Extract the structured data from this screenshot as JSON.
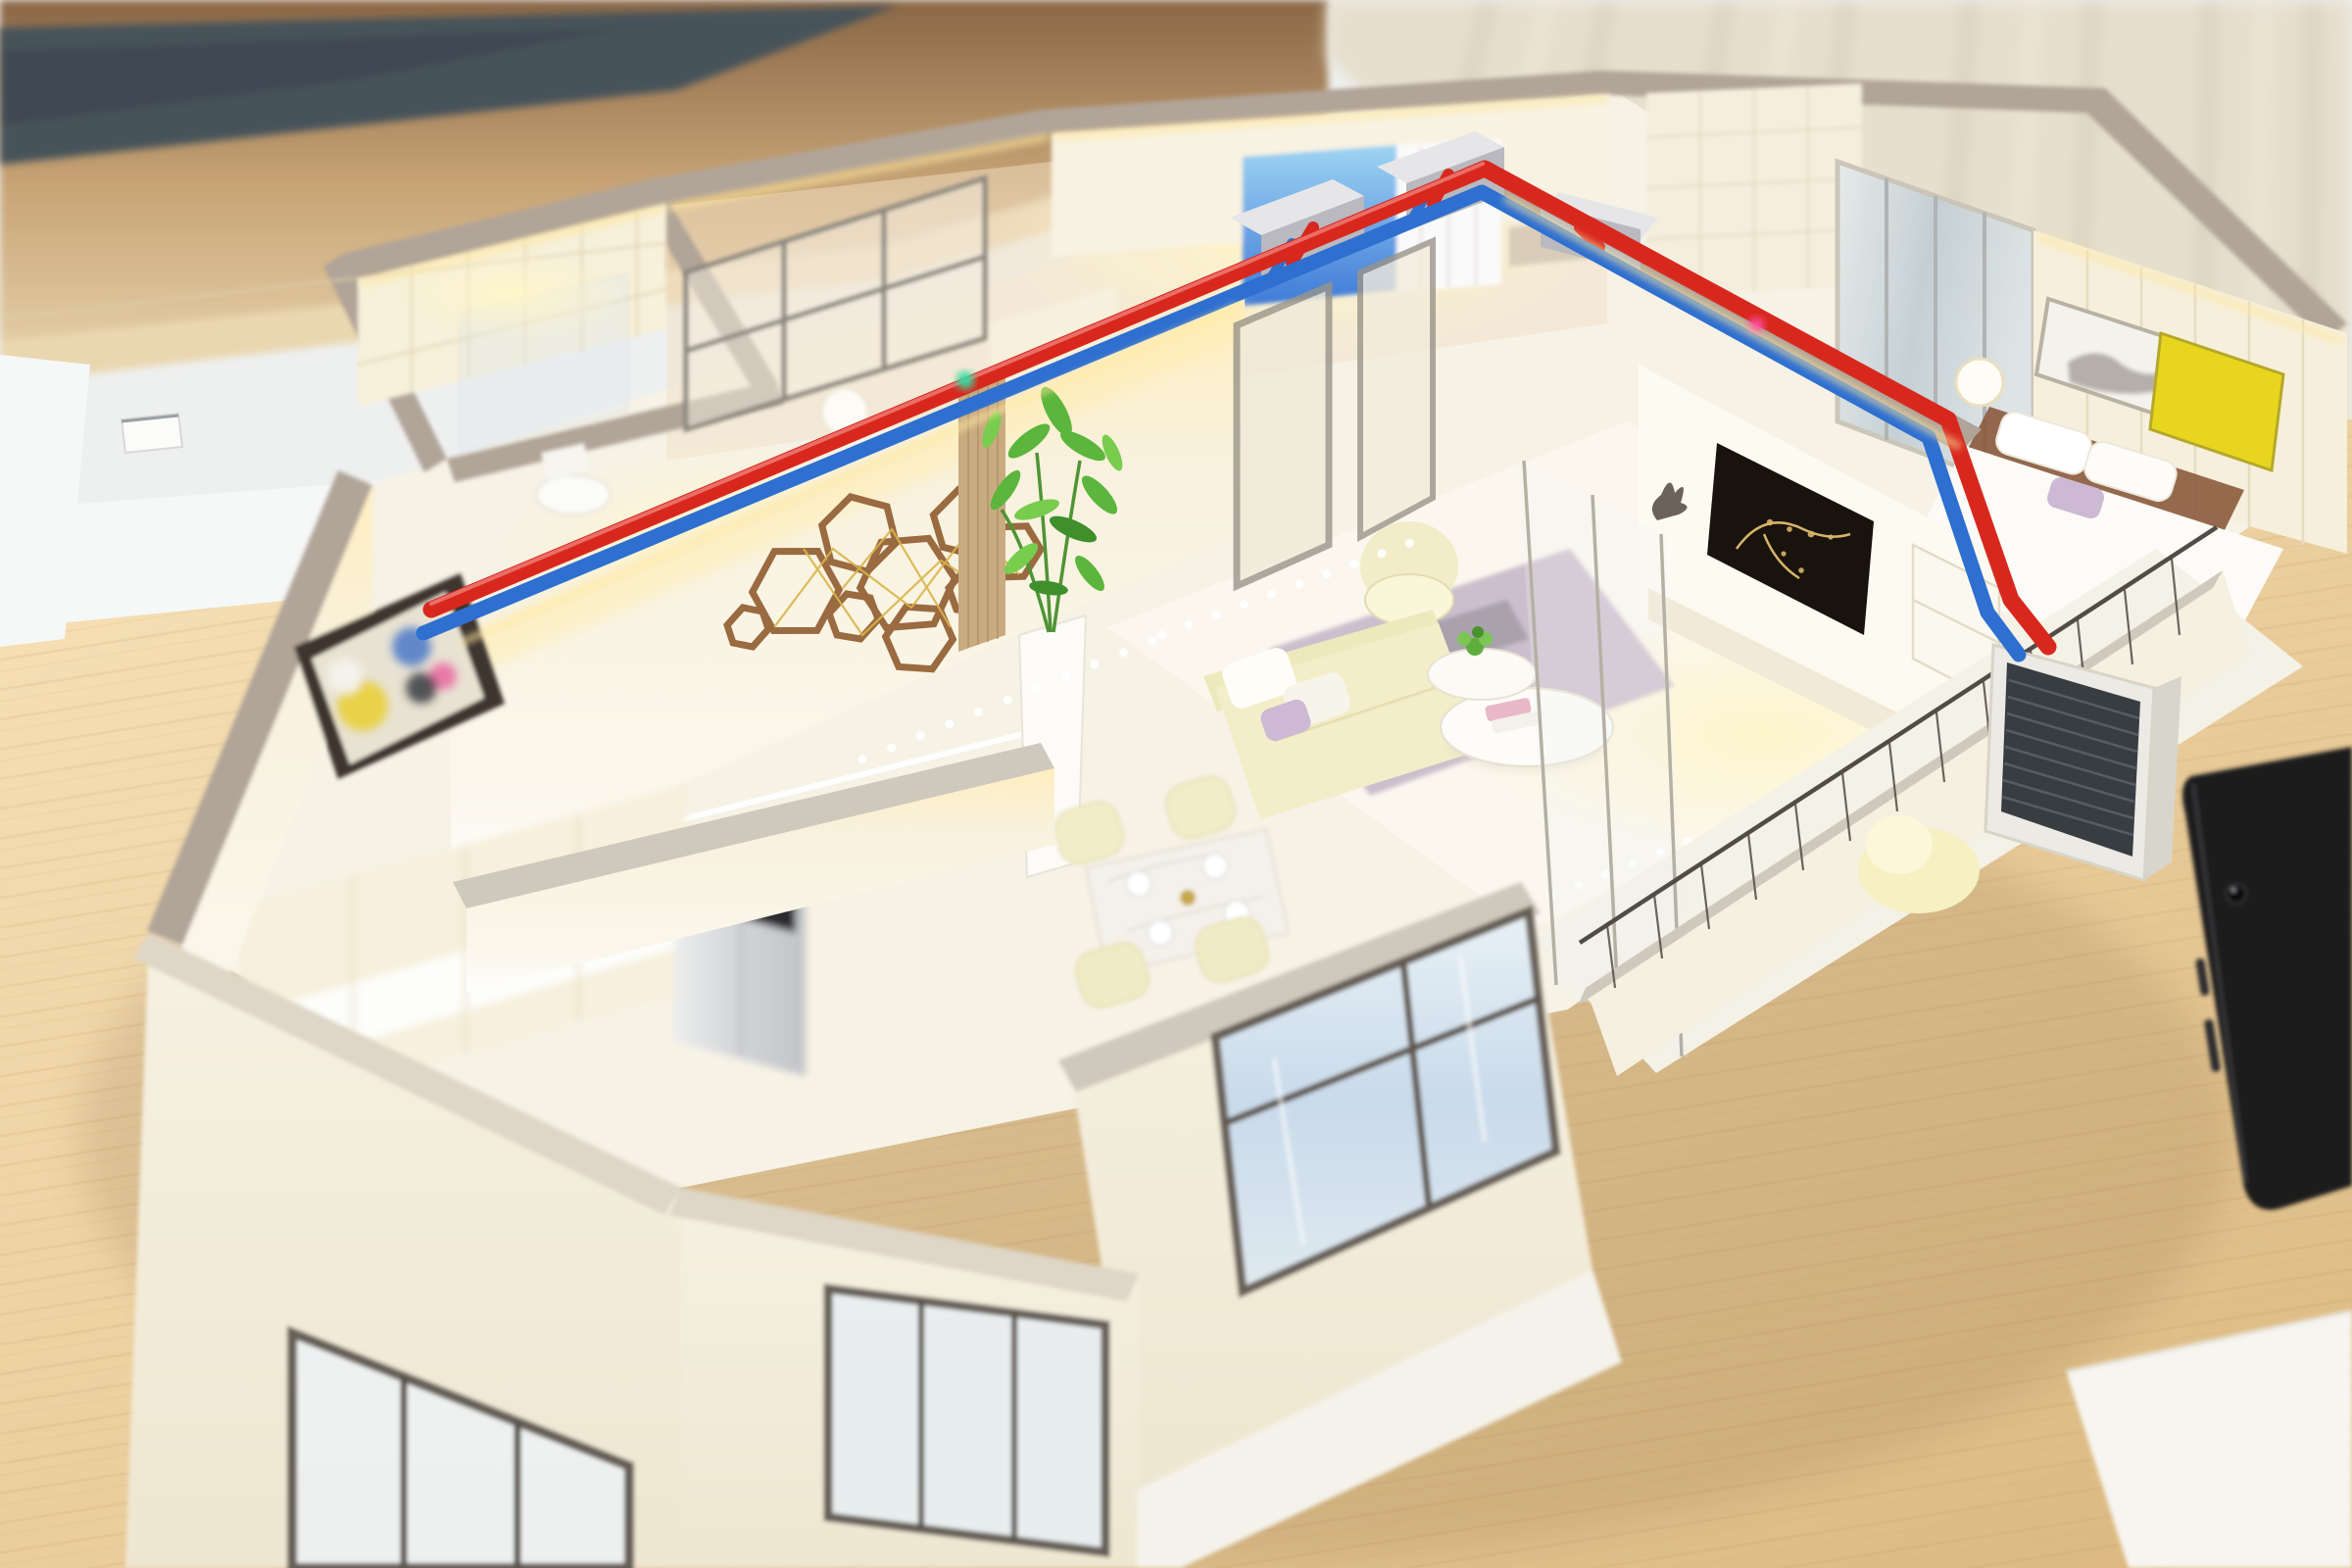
{
  "scene": {
    "type": "photograph",
    "subject": "Architectural cutaway scale model of an apartment with red/blue HVAC piping demo, standing on a light wood table",
    "camera": "elevated three-quarter view with shallow depth of field (tilt-shift look)",
    "no_visible_text": true
  },
  "palette": {
    "backdrop_white": "#eef0f0",
    "white_surface": "#f6f8f8",
    "slate_strip": "#47525a",
    "slate_dark": "#39444c",
    "shelf_wood": "#b08a5c",
    "shelf_wood_lip": "#ead7b0",
    "curtain_beige": "#e6dfcd",
    "curtain_fold": "#cdc2a8",
    "table_grain": "#c89a60",
    "wall_cream": "#f7f1de",
    "wall_cap_taupe": "#b1a498",
    "wall_cap_light": "#cfc8bc",
    "led_warm": "#ffe9a0",
    "pipe_red": "#d8281e",
    "pipe_blue": "#2e6fd0",
    "ac_box_top": "#e6e6e8",
    "ac_box_front": "#b9b9bf",
    "floor_tile": "#f6f2e6",
    "backroom_floor": "#f2dfc6",
    "rug_lavender": "#c8b9ca",
    "rug_yellow": "#e5c04a",
    "sofa_cream": "#f3eec9",
    "tv_black": "#18130d",
    "tv_gold": "#d8b36a",
    "art_yellow": "#e8d61e",
    "hex_art_brown": "#9a6a40",
    "hex_art_gold": "#d9b44a",
    "plant_green": "#5cb53c",
    "fridge_panel": "#2a2a2e",
    "outdoor_unit_louver": "#383d42",
    "screen_blue": "#5a9ae0",
    "glass_blue": "#dce9f4",
    "window_frame": "#5e564e",
    "tablet_black": "#1c1c1f",
    "paper_white": "#f7f5f0",
    "buddha_bronze": "#6b625a",
    "bed_headboard": "#8a5a3c",
    "pillow_lilac": "#cdb9d4",
    "marble_table": "#f4f1ea"
  },
  "background": {
    "wall_strip": {
      "label": "dark slate wall band at top"
    },
    "wood_shelf": {
      "label": "wooden shelf edge behind the model"
    },
    "backdrop": {
      "label": "pale backdrop wall"
    },
    "white_surface": {
      "label": "white surface behind the table"
    },
    "curtain": {
      "label": "beige curtain, top right"
    },
    "table": {
      "label": "light maple table under the model"
    }
  },
  "model": {
    "label": "apartment scale model with cutaway walls and LED lighting",
    "rooms": [
      {
        "id": "bathroom",
        "label": "tiled bathroom with toilet and glass shower"
      },
      {
        "id": "study",
        "label": "study behind framed glass partition"
      },
      {
        "id": "back-bedroom",
        "label": "bedroom with glowing blue screen and white curtain"
      },
      {
        "id": "hallway",
        "label": "back hallway with quilted tile wall"
      },
      {
        "id": "master-bedroom",
        "label": "master bedroom: mirrored wardrobe, bed, art with yellow panel"
      },
      {
        "id": "living-room",
        "label": "living room: TV wall, armchair, sofa set, rug, coffee tables"
      },
      {
        "id": "entry-hall",
        "label": "entry hall with hexagon wood art, abstract painting and plant"
      },
      {
        "id": "dining-room",
        "label": "dining room with marble table set for four"
      },
      {
        "id": "kitchen",
        "label": "kitchen with cream cabinets and silver refrigerator"
      },
      {
        "id": "balcony",
        "label": "balcony with outdoor unit, railing and lounge chair"
      }
    ],
    "piping": {
      "label": "refrigerant piping demonstration",
      "red_line": "hot / supply line",
      "blue_line": "cold / return line",
      "indoor_units": 3,
      "outdoor_units": 1
    },
    "lighting": "warm LED strips along wall tops, cool white LED dots in floors"
  },
  "foreground": {
    "tablet": {
      "label": "black tablet lying on the table, bottom right"
    },
    "paper": {
      "label": "white sheet of paper at the bottom edge"
    },
    "small_box": {
      "label": "small white box on the left shelf"
    }
  }
}
